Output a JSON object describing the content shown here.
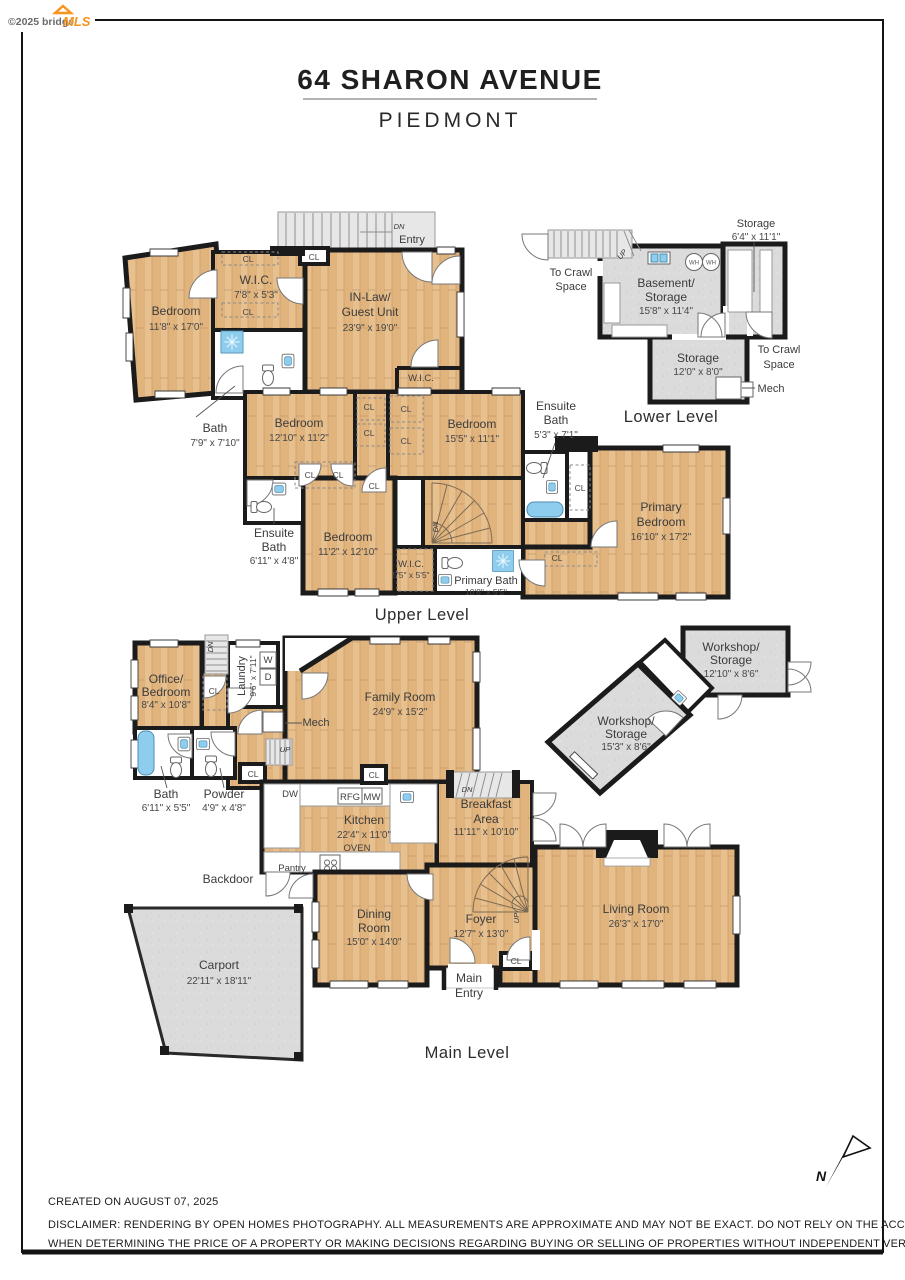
{
  "watermark": {
    "prefix": "©2025 bridge",
    "brand": "MLS"
  },
  "header": {
    "title": "64 SHARON AVENUE",
    "subtitle": "PIEDMONT"
  },
  "common": {
    "cl": "CL",
    "wic": "W.I.C.",
    "dn": "DN",
    "up": "UP",
    "wh": "WH",
    "washer_abbr": "W",
    "dryer_abbr": "D",
    "mech": "Mech",
    "entry": "Entry",
    "to_crawl_line1": "To Crawl",
    "to_crawl_line2": "Space"
  },
  "upper_level": {
    "label": "Upper Level",
    "rooms": {
      "bedroom_nw": {
        "name": "Bedroom",
        "dims": "11'8\" x 17'0\""
      },
      "wic_nw": {
        "name": "W.I.C.",
        "dims": "7'8\" x 5'3\""
      },
      "inlaw": {
        "name_line1": "IN-Law/",
        "name_line2": "Guest Unit",
        "dims": "23'9\" x 19'0\""
      },
      "bath_nw": {
        "name": "Bath",
        "dims": "7'9\" x 7'10\""
      },
      "bedroom_w": {
        "name": "Bedroom",
        "dims": "12'10\" x 11'2\""
      },
      "bedroom_c": {
        "name": "Bedroom",
        "dims": "15'5\" x 11'1\""
      },
      "ensuite_bath_e": {
        "name_line1": "Ensuite",
        "name_line2": "Bath",
        "dims": "5'3\" x 7'1\""
      },
      "ensuite_bath_w": {
        "name_line1": "Ensuite",
        "name_line2": "Bath",
        "dims": "6'11\" x 4'8\""
      },
      "bedroom_s": {
        "name": "Bedroom",
        "dims": "11'2\" x 12'10\""
      },
      "wic_s": {
        "name": "W.I.C.",
        "dims": "5'5\" x 5'5\""
      },
      "primary_bath": {
        "name": "Primary Bath",
        "dims": "10'8\" x 5'5\""
      },
      "primary_bedroom": {
        "name_line1": "Primary",
        "name_line2": "Bedroom",
        "dims": "16'10\" x 17'2\""
      }
    }
  },
  "lower_level": {
    "label": "Lower Level",
    "rooms": {
      "storage_e": {
        "name": "Storage",
        "dims": "6'4\" x 11'1\""
      },
      "basement": {
        "name_line1": "Basement/",
        "name_line2": "Storage",
        "dims": "15'8\" x 11'4\""
      },
      "storage_s": {
        "name": "Storage",
        "dims": "12'0\" x 8'0\""
      }
    }
  },
  "main_level": {
    "label": "Main Level",
    "rooms": {
      "office": {
        "name_line1": "Office/",
        "name_line2": "Bedroom",
        "dims": "8'4\" x 10'8\""
      },
      "laundry": {
        "name": "Laundry",
        "dims": "9'6\" x 7'11\""
      },
      "family_room": {
        "name": "Family Room",
        "dims": "24'9\" x 15'2\""
      },
      "bath": {
        "name": "Bath",
        "dims": "6'11\" x 5'5\""
      },
      "powder": {
        "name": "Powder",
        "dims": "4'9\" x 4'8\""
      },
      "kitchen": {
        "name": "Kitchen",
        "dims": "22'4\" x 11'0\""
      },
      "breakfast": {
        "name_line1": "Breakfast",
        "name_line2": "Area",
        "dims": "11'11\" x 10'10\""
      },
      "dining": {
        "name_line1": "Dining",
        "name_line2": "Room",
        "dims": "15'0\" x 14'0\""
      },
      "foyer": {
        "name": "Foyer",
        "dims": "12'7\" x 13'0\""
      },
      "living": {
        "name": "Living Room",
        "dims": "26'3\" x 17'0\""
      },
      "carport": {
        "name": "Carport",
        "dims": "22'11\" x 18'11\""
      },
      "workshop_ne": {
        "name_line1": "Workshop/",
        "name_line2": "Storage",
        "dims": "12'10\" x 8'6\""
      },
      "workshop_sw": {
        "name_line1": "Workshop/",
        "name_line2": "Storage",
        "dims": "15'3\" x 8'6\""
      }
    },
    "annotations": {
      "backdoor": "Backdoor",
      "pantry": "Pantry",
      "oven": "OVEN",
      "dw": "DW",
      "rfg": "RFG",
      "mw": "MW",
      "main_entry_line1": "Main",
      "main_entry_line2": "Entry"
    }
  },
  "compass": {
    "north": "N"
  },
  "footer": {
    "created": "CREATED ON AUGUST 07, 2025",
    "disclaimer_line1": "DISCLAIMER: RENDERING BY OPEN HOMES PHOTOGRAPHY. ALL MEASUREMENTS ARE APPROXIMATE AND MAY NOT BE EXACT. DO NOT RELY ON THE ACCURACY OF THIS FLOOR PLAN",
    "disclaimer_line2": "WHEN DETERMINING THE PRICE OF A PROPERTY OR MAKING DECISIONS REGARDING BUYING OR SELLING OF PROPERTIES WITHOUT INDEPENDENT VERIFICATION."
  },
  "colors": {
    "wall": "#1b1b1b",
    "wood_floor": "#e6bc8a",
    "concrete_floor": "#dcdcdc",
    "fixture_blue": "#8fcdee",
    "brand_orange": "#f7941d"
  }
}
